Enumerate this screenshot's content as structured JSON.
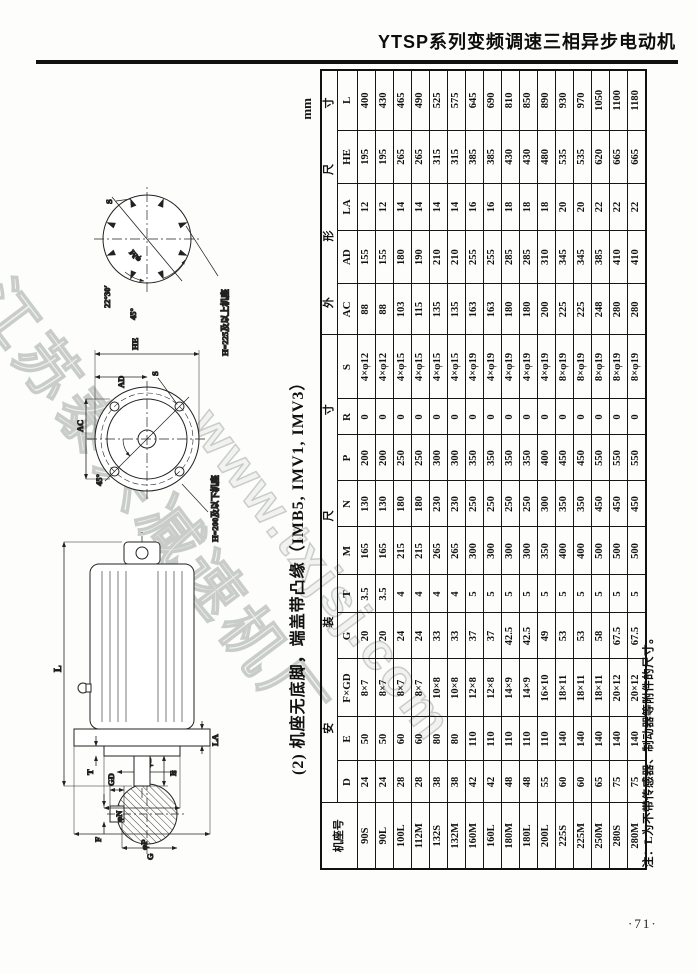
{
  "page": {
    "title": "YTSP系列变频调速三相异步电动机",
    "page_number": "·71·",
    "unit_label": "mm",
    "section_caption": "(2) 机座无底脚，端盖带凸缘（IMB5, IMV1, IMV3）",
    "table_note": "注：L为不带传感器、制动器等附件的尺寸。",
    "watermark": [
      "江苏泰兴减速机厂",
      "www.txjsj.com"
    ]
  },
  "figure": {
    "shaft_section": {
      "gd": "GD",
      "f": "F",
      "phi_d": "φD",
      "g": "G"
    },
    "side_view": {
      "l": "L",
      "t": "T",
      "e": "E",
      "la": "LA",
      "phi_n": "φN",
      "phi_p": "φP"
    },
    "flange_view": {
      "ac": "AC",
      "ad": "AD",
      "he": "HE",
      "s": "S",
      "angle45": "45°",
      "note": "H=200及以下机座"
    },
    "bolt_circle": {
      "s": "S",
      "phi_m": "φM",
      "angle2230": "22°30′",
      "angle45": "45°",
      "note": "H=225及以上机座"
    }
  },
  "table": {
    "frame_header": "机座号",
    "group_installation": "安 装 尺 寸",
    "group_outline": "外 形 尺 寸",
    "columns": [
      "D",
      "E",
      "F×GD",
      "G",
      "T",
      "M",
      "N",
      "P",
      "R",
      "S",
      "AC",
      "AD",
      "LA",
      "HE",
      "L"
    ],
    "rows": [
      [
        "90S",
        "24",
        "50",
        "8×7",
        "20",
        "3.5",
        "165",
        "130",
        "200",
        "0",
        "4×φ12",
        "88",
        "155",
        "12",
        "195",
        "400"
      ],
      [
        "90L",
        "24",
        "50",
        "8×7",
        "20",
        "3.5",
        "165",
        "130",
        "200",
        "0",
        "4×φ12",
        "88",
        "155",
        "12",
        "195",
        "430"
      ],
      [
        "100L",
        "28",
        "60",
        "8×7",
        "24",
        "4",
        "215",
        "180",
        "250",
        "0",
        "4×φ15",
        "103",
        "180",
        "14",
        "265",
        "465"
      ],
      [
        "112M",
        "28",
        "60",
        "8×7",
        "24",
        "4",
        "215",
        "180",
        "250",
        "0",
        "4×φ15",
        "115",
        "190",
        "14",
        "265",
        "490"
      ],
      [
        "132S",
        "38",
        "80",
        "10×8",
        "33",
        "4",
        "265",
        "230",
        "300",
        "0",
        "4×φ15",
        "135",
        "210",
        "14",
        "315",
        "525"
      ],
      [
        "132M",
        "38",
        "80",
        "10×8",
        "33",
        "4",
        "265",
        "230",
        "300",
        "0",
        "4×φ15",
        "135",
        "210",
        "14",
        "315",
        "575"
      ],
      [
        "160M",
        "42",
        "110",
        "12×8",
        "37",
        "5",
        "300",
        "250",
        "350",
        "0",
        "4×φ19",
        "163",
        "255",
        "16",
        "385",
        "645"
      ],
      [
        "160L",
        "42",
        "110",
        "12×8",
        "37",
        "5",
        "300",
        "250",
        "350",
        "0",
        "4×φ19",
        "163",
        "255",
        "16",
        "385",
        "690"
      ],
      [
        "180M",
        "48",
        "110",
        "14×9",
        "42.5",
        "5",
        "300",
        "250",
        "350",
        "0",
        "4×φ19",
        "180",
        "285",
        "18",
        "430",
        "810"
      ],
      [
        "180L",
        "48",
        "110",
        "14×9",
        "42.5",
        "5",
        "300",
        "250",
        "350",
        "0",
        "4×φ19",
        "180",
        "285",
        "18",
        "430",
        "850"
      ],
      [
        "200L",
        "55",
        "110",
        "16×10",
        "49",
        "5",
        "350",
        "300",
        "400",
        "0",
        "4×φ19",
        "200",
        "310",
        "18",
        "480",
        "890"
      ],
      [
        "225S",
        "60",
        "140",
        "18×11",
        "53",
        "5",
        "400",
        "350",
        "450",
        "0",
        "8×φ19",
        "225",
        "345",
        "20",
        "535",
        "930"
      ],
      [
        "225M",
        "60",
        "140",
        "18×11",
        "53",
        "5",
        "400",
        "350",
        "450",
        "0",
        "8×φ19",
        "225",
        "345",
        "20",
        "535",
        "970"
      ],
      [
        "250M",
        "65",
        "140",
        "18×11",
        "58",
        "5",
        "500",
        "450",
        "550",
        "0",
        "8×φ19",
        "248",
        "385",
        "22",
        "620",
        "1050"
      ],
      [
        "280S",
        "75",
        "140",
        "20×12",
        "67.5",
        "5",
        "500",
        "450",
        "550",
        "0",
        "8×φ19",
        "280",
        "410",
        "22",
        "665",
        "1100"
      ],
      [
        "280M",
        "75",
        "140",
        "20×12",
        "67.5",
        "5",
        "500",
        "450",
        "550",
        "0",
        "8×φ19",
        "280",
        "410",
        "22",
        "665",
        "1180"
      ]
    ]
  }
}
